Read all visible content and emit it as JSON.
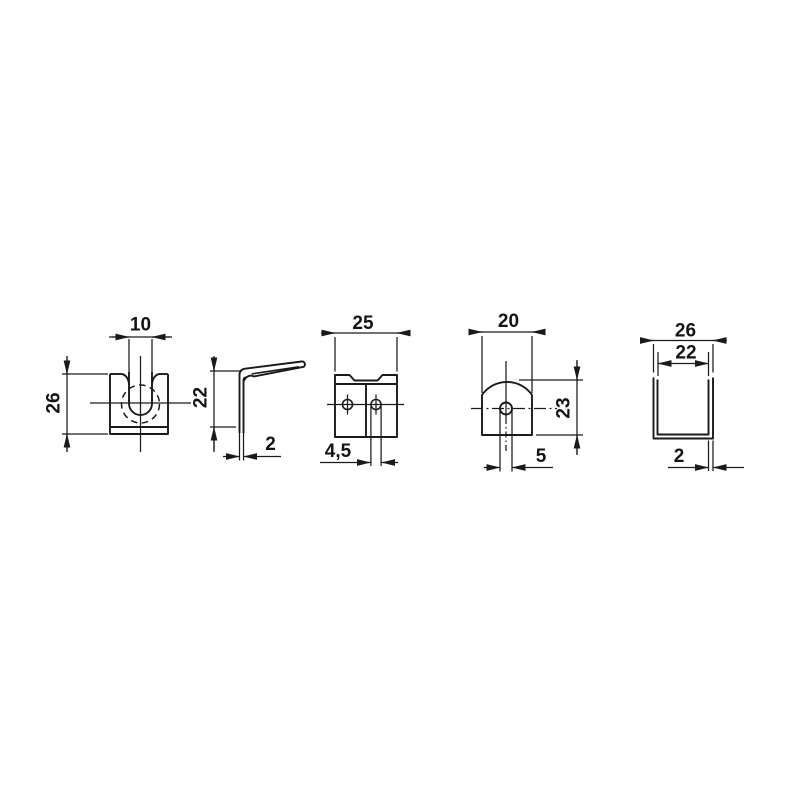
{
  "page": {
    "background_color": "#ffffff",
    "ink_color": "#1a1a1a"
  },
  "drawing": {
    "kind": "technical-drawing",
    "description": "five orthographic views of a sheet-metal spring clip with dimensions in mm",
    "views": {
      "clip_front": {
        "name": "clip front view",
        "slot_width": "10",
        "height": "26"
      },
      "clip_side": {
        "name": "clip side profile view",
        "leg_height": "22",
        "material_thickness": "2"
      },
      "plate_front": {
        "name": "base plate view",
        "width": "25",
        "hole_diameter": "4,5"
      },
      "round_tab": {
        "name": "round-top tab view",
        "width": "20",
        "height": "23",
        "tab_hole_width": "5"
      },
      "channel": {
        "name": "u-channel section view",
        "outer_width": "26",
        "inner_width": "22",
        "wall_thickness": "2"
      }
    }
  }
}
